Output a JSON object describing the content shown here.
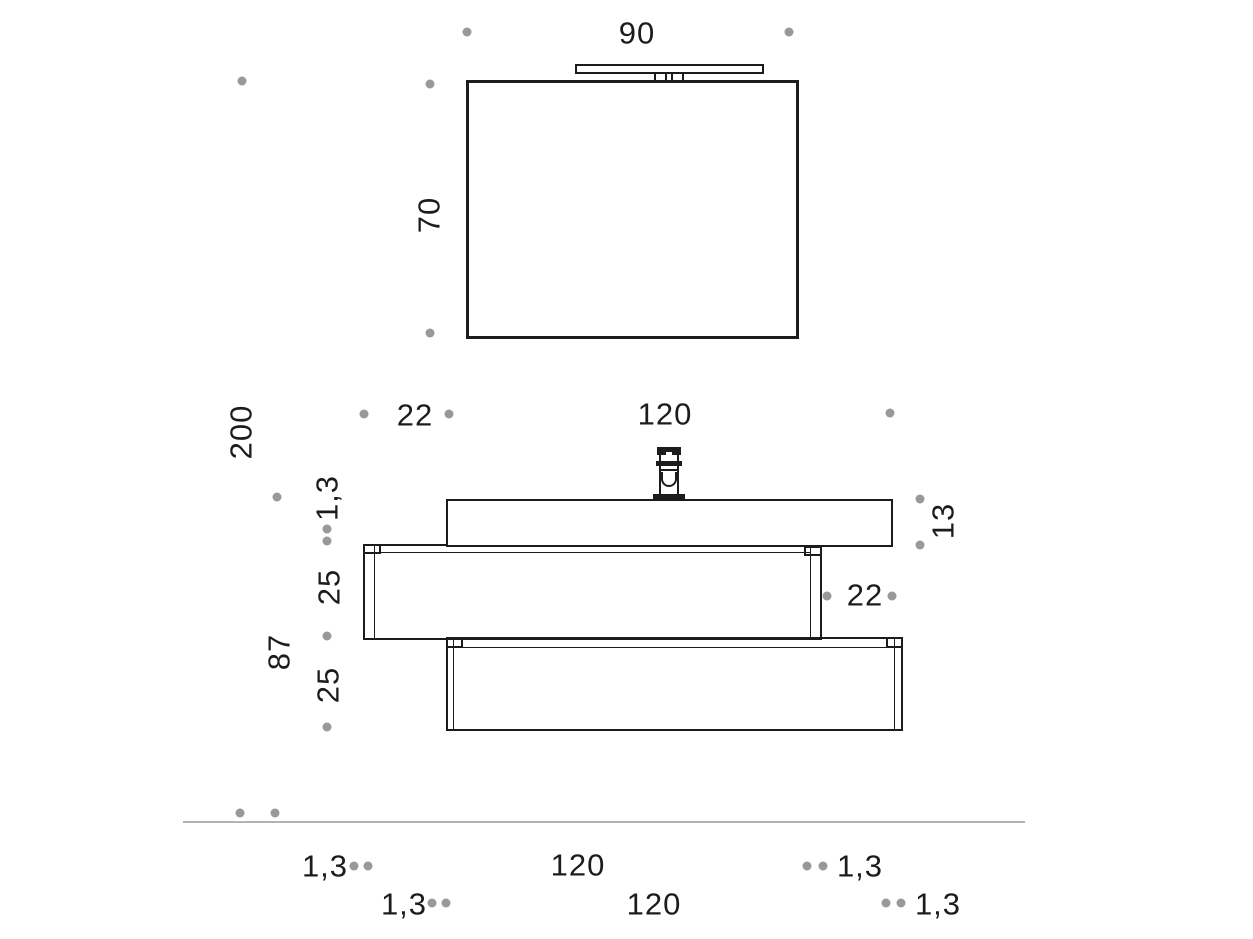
{
  "title": "Bathroom vanity unit technical dimension drawing",
  "colors": {
    "line": "#1c1c1c",
    "dot": "#999999",
    "floor": "#b3b3b3"
  },
  "labels": {
    "mirror_width": "90",
    "mirror_height": "70",
    "overall_height": "200",
    "mirror_gap": "22",
    "basin_width": "120",
    "worktop_thickness": "1,3",
    "upper_drawer_height": "25",
    "base_unit_height": "87",
    "lower_drawer_height": "25",
    "basin_height": "13",
    "side_offset": "22",
    "upper_panel_thickness_left": "1,3",
    "upper_unit_width": "120",
    "lower_panel_thickness_left": "1,3",
    "lower_unit_width": "120",
    "upper_panel_thickness_right": "1,3",
    "lower_panel_thickness_right": "1,3"
  }
}
